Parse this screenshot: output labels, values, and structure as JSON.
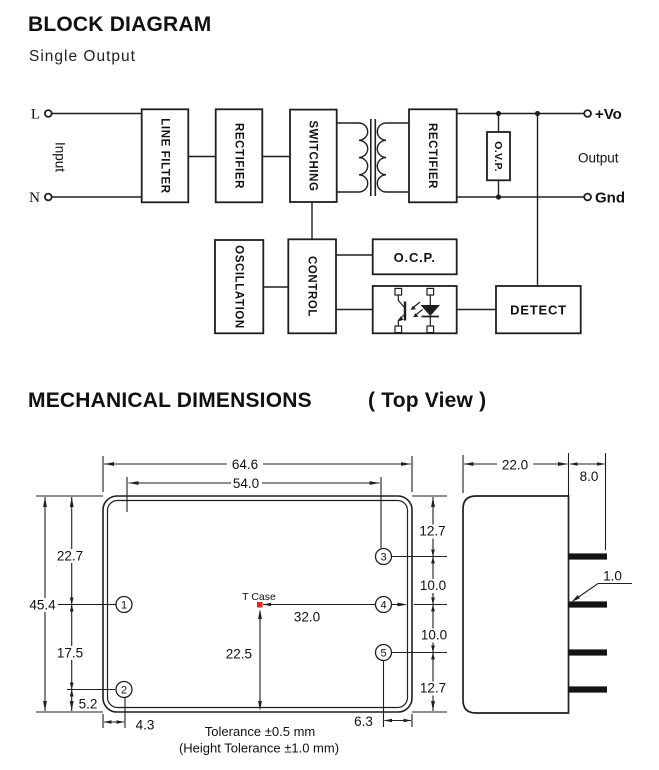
{
  "colors": {
    "line": "#1f1f1f",
    "text": "#111111",
    "tcase_dot": "#e8231f",
    "background": "#ffffff"
  },
  "block_diagram": {
    "title": "BLOCK DIAGRAM",
    "subtitle": "Single Output",
    "input": {
      "live": "L",
      "neutral": "N",
      "label": "Input"
    },
    "blocks": {
      "line_filter": "LINE FILTER",
      "rectifier_input": "RECTIFIER",
      "switching": "SWITCHING",
      "rectifier_output": "RECTIFIER",
      "ovp": "O.V.P.",
      "oscillation": "OSCILLATION",
      "control": "CONTROL",
      "ocp": "O.C.P.",
      "detect": "DETECT"
    },
    "output": {
      "positive": "+Vo",
      "label": "Output",
      "ground": "Gnd"
    }
  },
  "mechanical": {
    "title": "MECHANICAL DIMENSIONS",
    "view_label": "( Top View )",
    "top_view": {
      "case_width": "64.6",
      "pin_span": "54.0",
      "case_height": "45.4",
      "top_to_pin1": "22.7",
      "pin1_to_pin2": "17.5",
      "pin2_to_bottom": "5.2",
      "edge_to_pin_left": "4.3",
      "top_to_pin3": "12.7",
      "pin3_to_pin4": "10.0",
      "pin4_to_pin5": "10.0",
      "pin5_to_bottom": "12.7",
      "pin_to_edge_right": "6.3",
      "tcase_to_pin4": "32.0",
      "tcase_to_bottom": "22.5",
      "tcase_label": "T Case",
      "pin_numbers": [
        "1",
        "2",
        "3",
        "4",
        "5"
      ],
      "tolerance_note": "Tolerance ±0.5 mm",
      "height_tolerance_note": "(Height Tolerance ±1.0 mm)"
    },
    "side_view": {
      "body_depth": "22.0",
      "pin_length": "8.0",
      "pin_thickness": "1.0"
    }
  }
}
